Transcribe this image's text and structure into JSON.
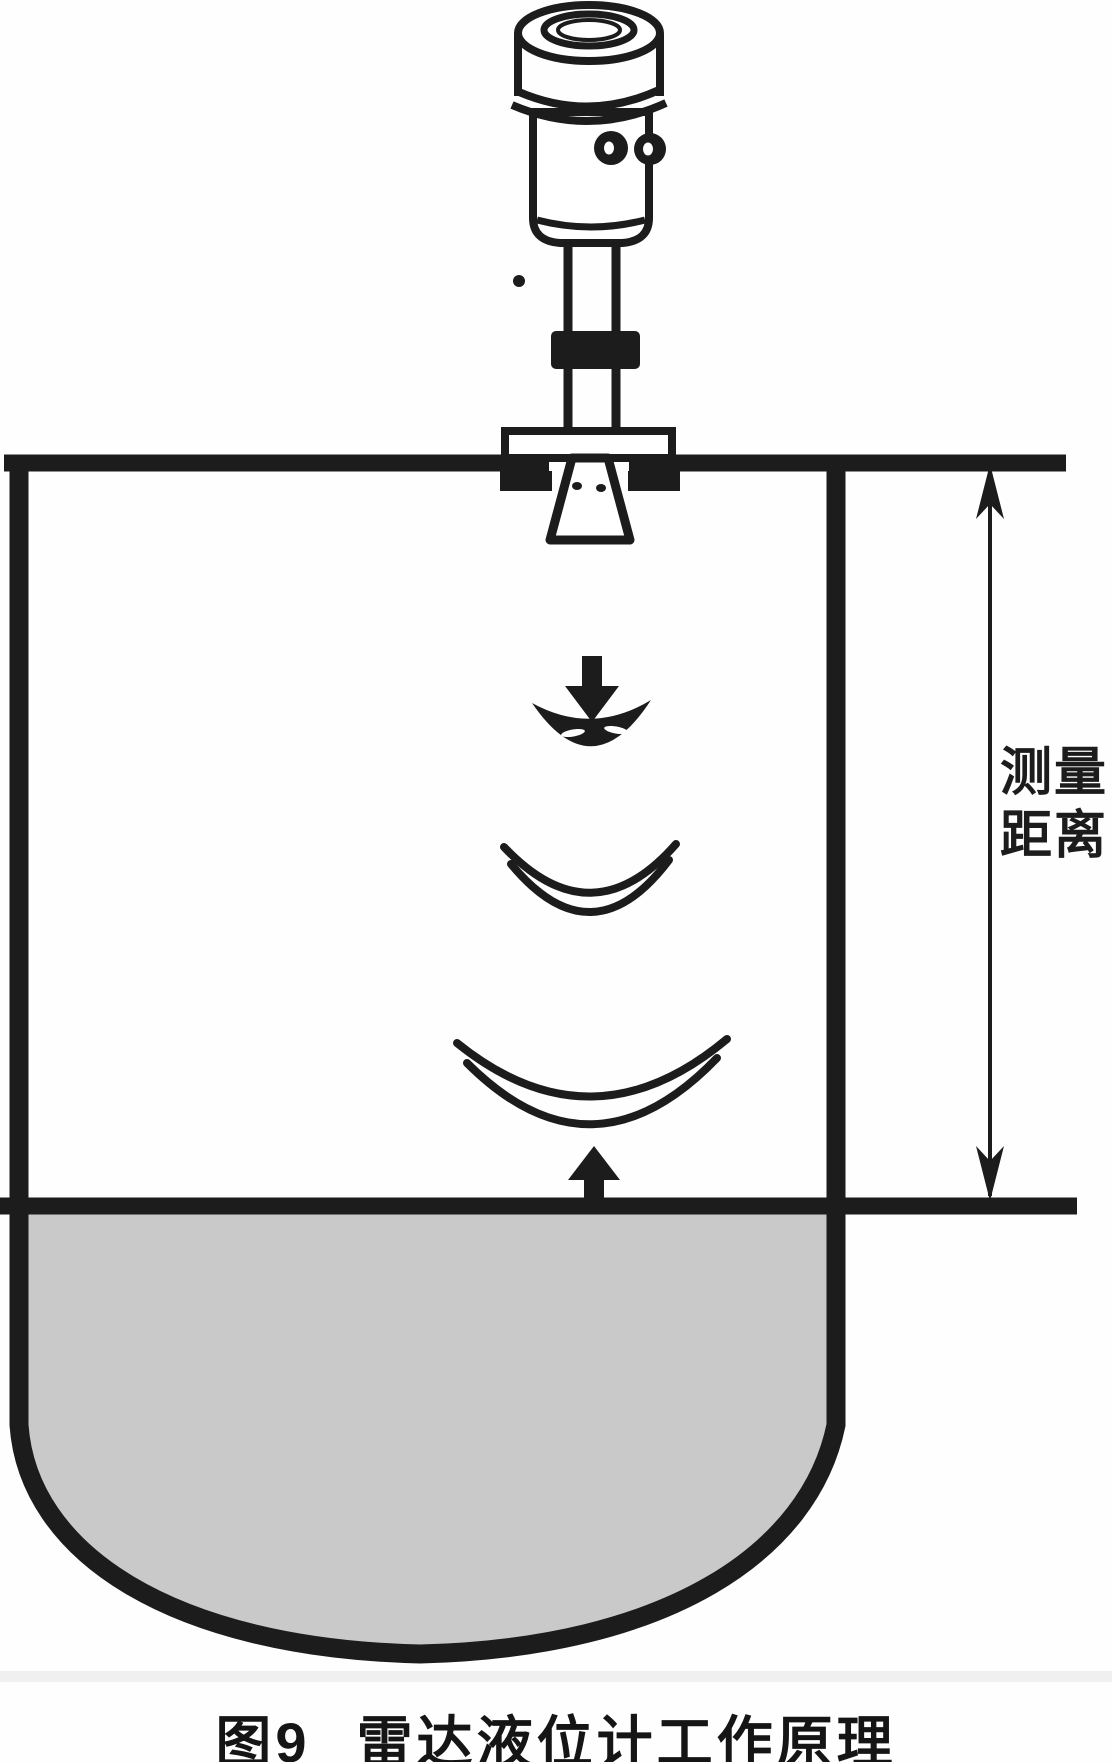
{
  "diagram": {
    "type": "technical-figure",
    "subject": "radar-level-gauge-working-principle",
    "dimension_label": {
      "line1": "测量",
      "line2": "距离"
    },
    "caption": {
      "prefix": "图9",
      "title": "雷达液位计工作原理"
    },
    "components": [
      "radar-transmitter-head",
      "antenna-neck-pipe",
      "pipe-coupling",
      "mounting-flange",
      "horn-antenna",
      "tank-shell",
      "radar-wave-arc-small",
      "radar-wave-arc-medium",
      "radar-wave-arc-large",
      "emitted-signal-arrow",
      "reflected-signal-arrow",
      "liquid-surface-line",
      "stored-liquid",
      "measuring-distance-dimension-line"
    ]
  },
  "colors": {
    "ink": "#1c1c1c",
    "liquid_fill": "#c9c9c9",
    "scan_line": "#e3e3e3",
    "background": "#fefefe"
  }
}
